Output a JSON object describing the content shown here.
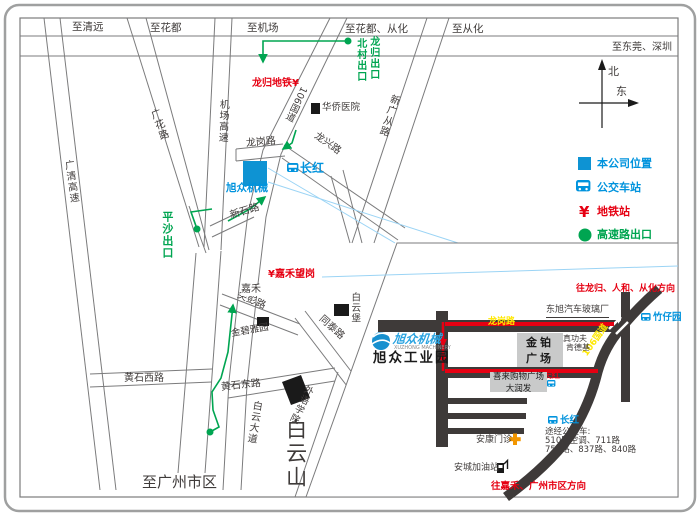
{
  "top": {
    "qingyuan": "至清远",
    "huadu": "至花都",
    "jichang": "至机场",
    "huadu_conghua": "至花都、从化",
    "conghua": "至从化",
    "dongguan_shenzhen": "至东莞、深圳"
  },
  "roads": {
    "guangqing_expwy": "广清高速",
    "guanghua_rd": "广花路",
    "jichang_expwy": "机场高速",
    "g106": "106国道",
    "xinguangcong_rd": "新广从路",
    "longgang_rd": "龙岗路",
    "longxing_rd": "龙兴路",
    "xinshi_rd": "新石路",
    "jianpeng_rd": "尖彭路",
    "tongtai_rd": "同泰路",
    "huangshi_w_rd": "黄石西路",
    "huangshi_e_rd": "黄石东路",
    "baiyun_ave": "白云大道"
  },
  "green_exits": {
    "pingsha": "平沙出口",
    "beicun": "北村出口",
    "longgui": "龙归出口"
  },
  "metro": {
    "longgui_station": "龙归地铁",
    "jiahewanggang": "嘉禾望岗"
  },
  "bus_stops": {
    "changhong": "长红"
  },
  "places": {
    "huaqiao_hospital": "华侨医院",
    "company": "旭众机械",
    "jiahe": "嘉禾",
    "baiyunbao": "白云堡",
    "jinbiyayuan": "金碧雅园",
    "waiyu_college": "外语学院",
    "baiyun_mountain": "白云山",
    "to_guangzhou": "至广州市区"
  },
  "legend": {
    "company": "本公司位置",
    "bus": "公交车站",
    "metro": "地铁站",
    "expwy_exit": "高速路出口"
  },
  "compass": {
    "north": "北",
    "east": "东"
  },
  "icons": {
    "metro_symbol": "¥"
  },
  "inset": {
    "dir_top": "往龙归、人和、从化方向",
    "dir_bottom": "往嘉禾、广州市区方向",
    "longgang_rd": "龙岗路",
    "g106": "106国道",
    "dongxu_glass": "东旭汽车玻璃厂",
    "zhuzaiyuan": "竹仔园",
    "jinbo_line1": "金铂",
    "jinbo_line2": "广场",
    "zhengongfu": "真功夫",
    "kfc": "肯德基",
    "changhong_stop": "长红",
    "xilai_mall": "喜来购物广场",
    "darunfa": "大润发",
    "changhong2": "长红",
    "bus_lines": [
      "途经公交车:",
      "510路空调、711路",
      "753路、837路、840路"
    ],
    "ankang_clinic": "安康门诊",
    "ancheng_gas": "安城加油站",
    "logo_brand": "旭众机械",
    "logo_latin": "XUZHONG MACHINERY",
    "logo_park": "旭众工业园"
  },
  "colors": {
    "company_blue": "#0e93d3",
    "text_blue": "#0093dd",
    "route_green": "#00a551",
    "alert_red": "#e60012",
    "road_yellow": "#ffe800",
    "connector_blue": "#9bd4f5",
    "inset_road": "#3e3a39"
  }
}
